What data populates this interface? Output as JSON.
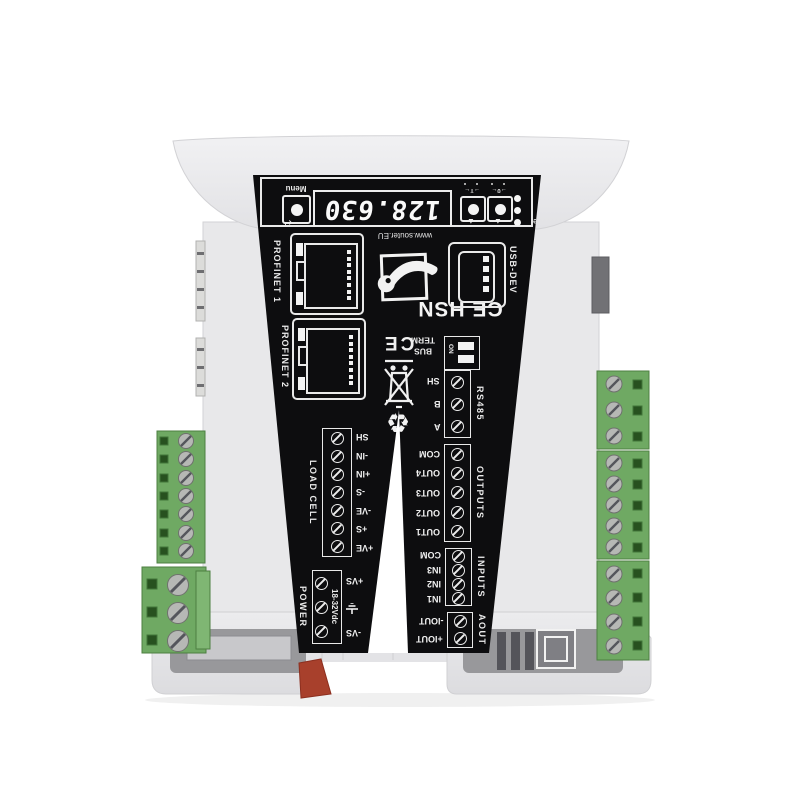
{
  "product": {
    "website": "www.souter.EU",
    "model": "CE HSN"
  },
  "display_area": {
    "menu_label": "Menu",
    "enter_symbol": "↵",
    "display_value": "128.630",
    "buttons": [
      {
        "symbol": "→T←",
        "arrow": "▲"
      },
      {
        "symbol": "→0←",
        "arrow": "▲"
      }
    ],
    "leds": [
      {
        "label": "Tare"
      },
      {
        "label": "Zero"
      },
      {
        "label": "Stable"
      }
    ]
  },
  "ports": {
    "profinet1": "PROFINET 1",
    "profinet2": "PROFINET 2",
    "usb": "USB-DEV"
  },
  "markings": {
    "ce": "CE",
    "recycle": "♻",
    "bus_term_line1": "BUS",
    "bus_term_line2": "TERM",
    "dip_on": "ON"
  },
  "terminal_groups": {
    "rs485": {
      "label": "RS485",
      "terminals": [
        "SH",
        "B",
        "A"
      ]
    },
    "outputs": {
      "label": "OUTPUTS",
      "terminals": [
        "COM",
        "OUT4",
        "OUT3",
        "OUT2",
        "OUT1"
      ]
    },
    "inputs": {
      "label": "INPUTS",
      "terminals": [
        "COM",
        "IN3",
        "IN2",
        "IN1"
      ]
    },
    "aout": {
      "label": "AOUT",
      "terminals": [
        "-IOUT",
        "+IOUT"
      ]
    },
    "load_cell": {
      "label": "LOAD CELL",
      "terminals": [
        "SH",
        "-IN",
        "+IN",
        "-S",
        "-VE",
        "+S",
        "+VE"
      ]
    },
    "power": {
      "label": "POWER",
      "range": "18-32Vdc",
      "terminals": [
        "+VS",
        "⏚",
        "-VS"
      ]
    }
  },
  "colors": {
    "panel": "#0d0d0f",
    "body": "#e9e9ea",
    "connector_green": "#6fa963",
    "clip_red": "#a8402c"
  }
}
